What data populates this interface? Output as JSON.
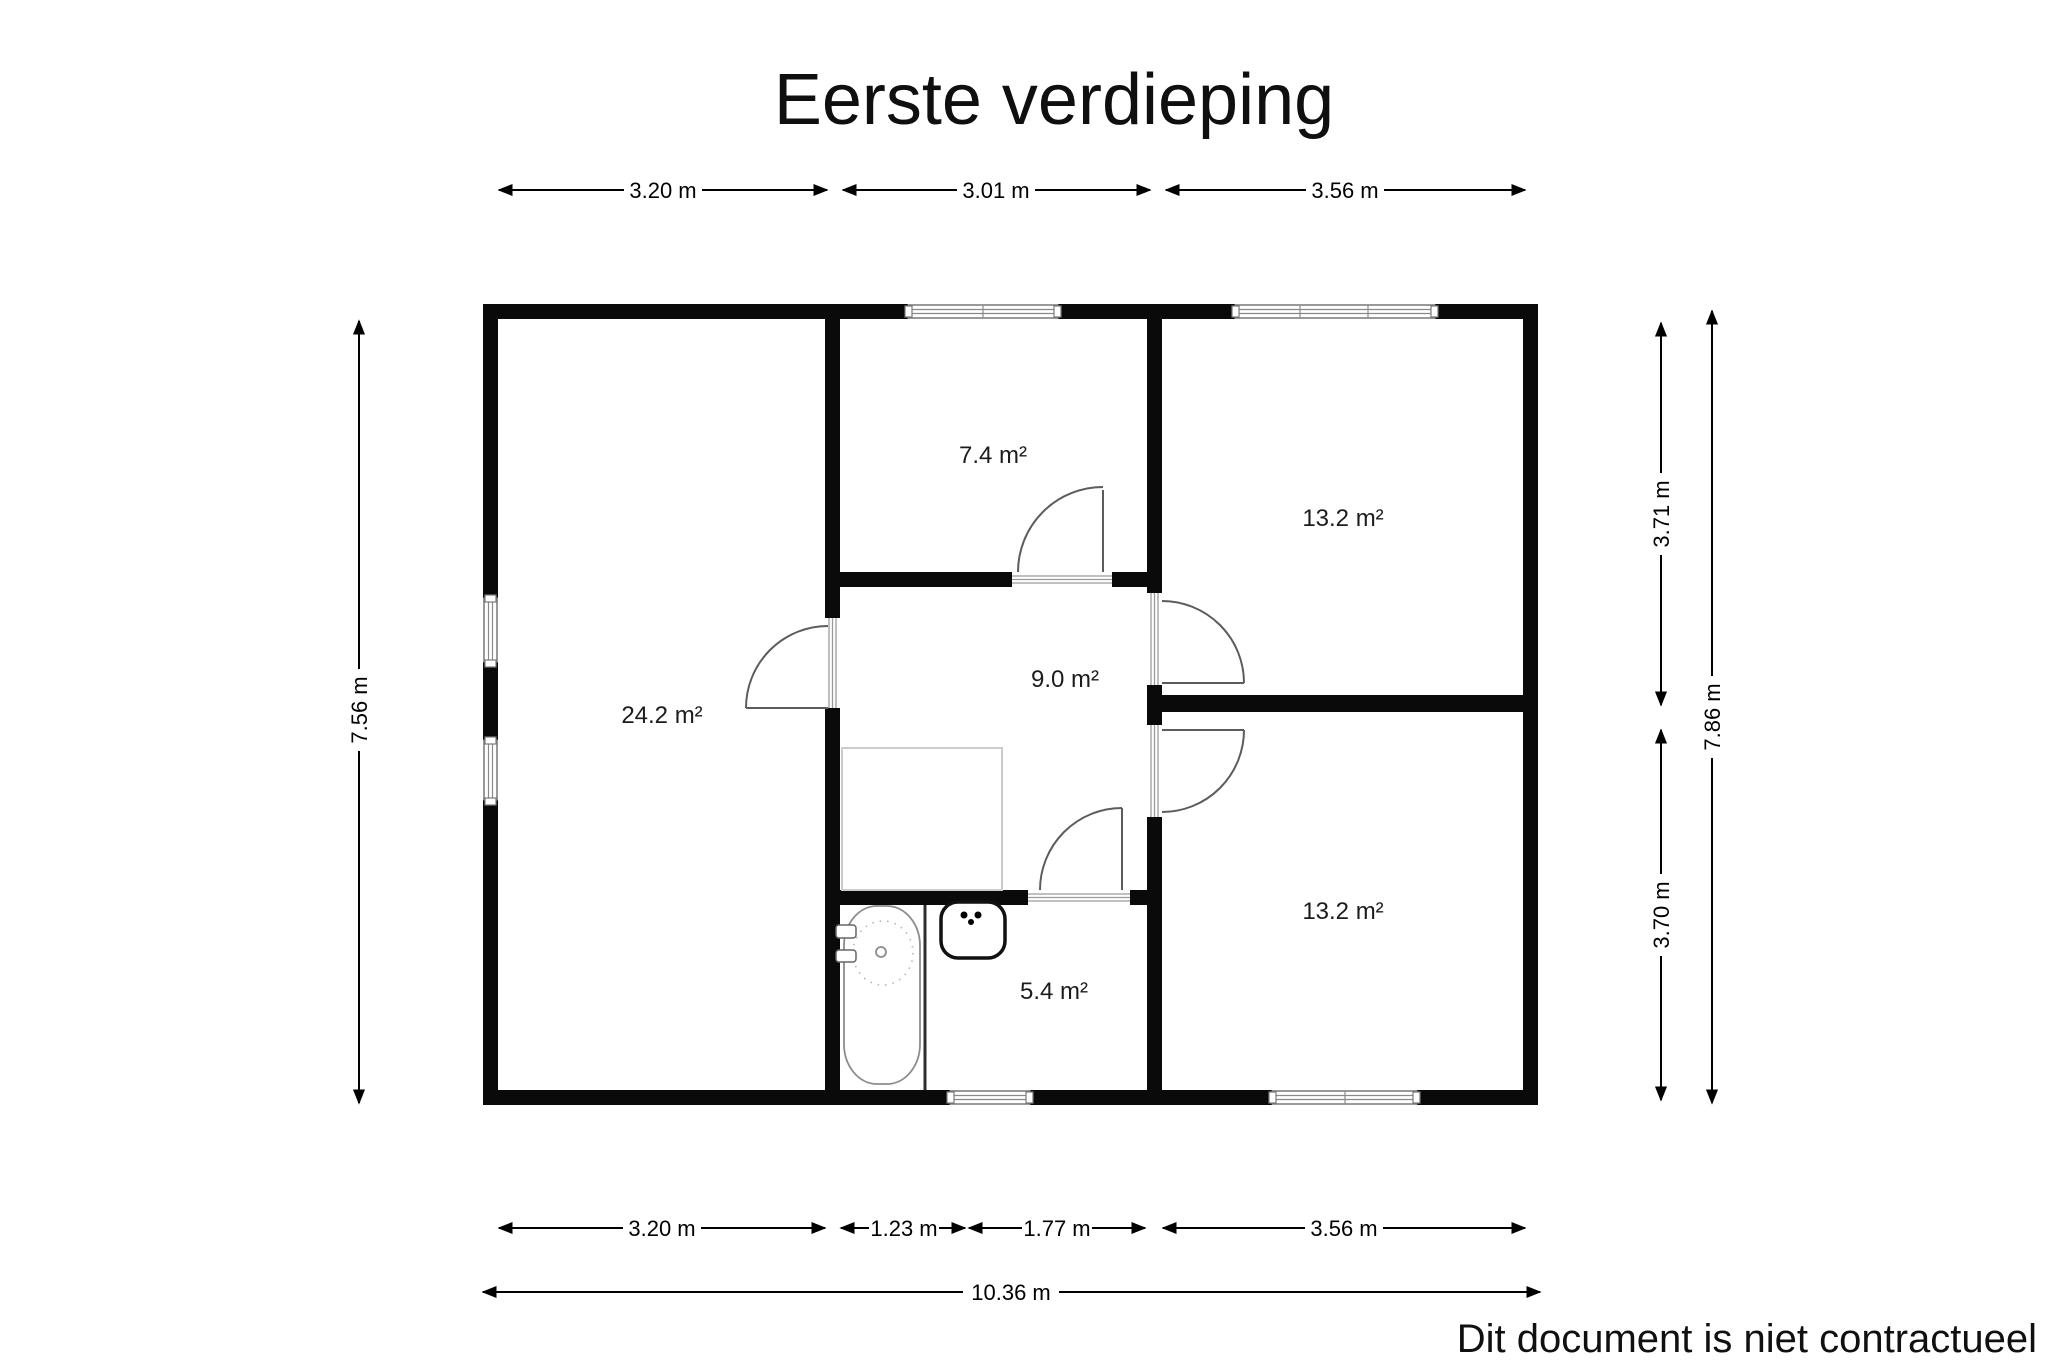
{
  "title": "Eerste verdieping",
  "disclaimer": "Dit document is niet contractueel",
  "rooms": {
    "living": "24.2 m²",
    "top_small": "7.4 m²",
    "hall": "9.0 m²",
    "bedroom_top": "13.2 m²",
    "bedroom_bottom": "13.2 m²",
    "bathroom": "5.4 m²"
  },
  "dims": {
    "top": [
      "3.20 m",
      "3.01 m",
      "3.56 m"
    ],
    "bottom": [
      "3.20 m",
      "1.23 m",
      "1.77 m",
      "3.56 m"
    ],
    "total_width": "10.36 m",
    "left_height": "7.56 m",
    "right_top": "3.71 m",
    "right_total": "7.86 m",
    "right_bottom": "3.70 m"
  },
  "colors": {
    "wall": "#0a0a0a",
    "background": "#ffffff",
    "door_arc": "#5c5c5c",
    "window_gray": "#8a8a8a"
  }
}
